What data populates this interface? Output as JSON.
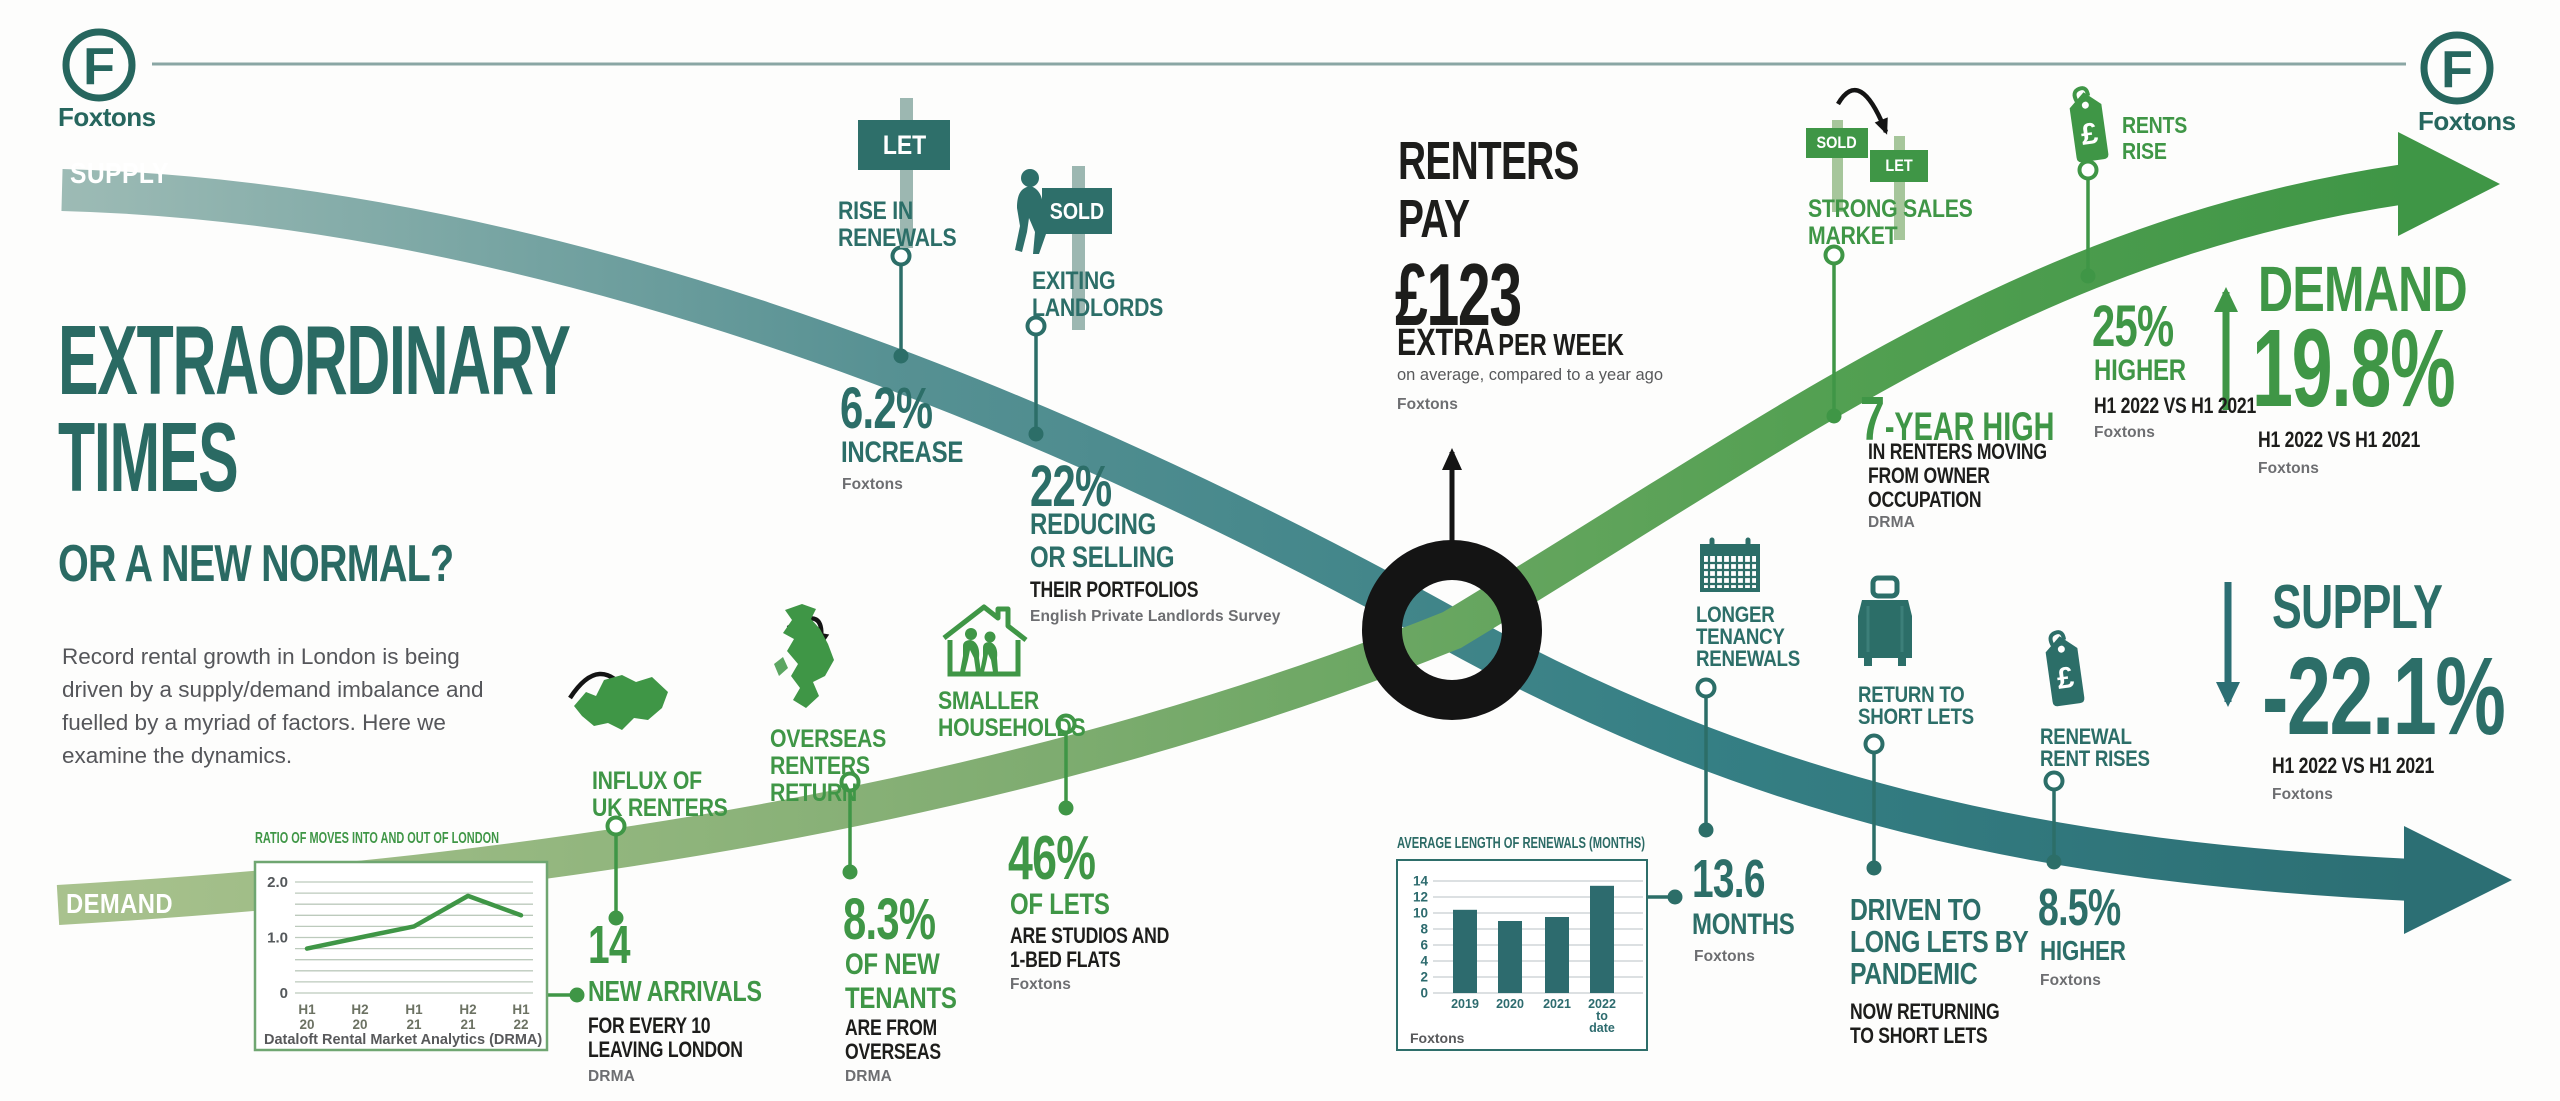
{
  "brand": {
    "logo_letter": "F",
    "wordmark": "Foxtons"
  },
  "curves": {
    "supply_label": "SUPPLY",
    "demand_label": "DEMAND"
  },
  "header": {
    "title": "EXTRAORDINARY\nTIMES",
    "subtitle": "OR A NEW NORMAL?",
    "intro": "Record rental growth in London is being\ndriven by a supply/demand imbalance and\nfuelled by a myriad of factors. Here we\nexamine the dynamics."
  },
  "center_stat": {
    "line1": "RENTERS",
    "line2": "PAY",
    "amount": "£123",
    "extra": "EXTRA",
    "per": "PER WEEK",
    "note": "on average, compared to a year ago",
    "source": "Foxtons"
  },
  "stats": {
    "rise_in_renewals": {
      "sign": "LET",
      "label": "RISE IN\nRENEWALS",
      "value": "6.2%",
      "unit": "INCREASE",
      "source": "Foxtons"
    },
    "exiting_landlords": {
      "sign": "SOLD",
      "label": "EXITING\nLANDLORDS",
      "value": "22%",
      "unit": "REDUCING\nOR SELLING",
      "detail": "THEIR PORTFOLIOS",
      "source": "English Private Landlords Survey"
    },
    "influx_uk": {
      "label": "INFLUX OF\nUK RENTERS",
      "value": "14",
      "unit": "NEW ARRIVALS",
      "detail": "FOR EVERY 10\nLEAVING LONDON",
      "source": "DRMA"
    },
    "overseas": {
      "label": "OVERSEAS\nRENTERS\nRETURN",
      "value": "8.3%",
      "unit": "OF NEW\nTENANTS",
      "detail": "ARE FROM\nOVERSEAS",
      "source": "DRMA"
    },
    "smaller_households": {
      "label": "SMALLER\nHOUSEHOLDS",
      "value": "46%",
      "unit": "OF LETS",
      "detail": "ARE STUDIOS AND\n1-BED FLATS",
      "source": "Foxtons"
    },
    "strong_sales": {
      "sign_from": "SOLD",
      "sign_to": "LET",
      "label": "STRONG SALES\nMARKET",
      "value": "7",
      "suffix": "-YEAR HIGH",
      "detail": "IN RENTERS MOVING\nFROM OWNER\nOCCUPATION",
      "source": "DRMA"
    },
    "rents_rise": {
      "tag": "£",
      "label": "RENTS\nRISE",
      "value": "25%",
      "unit": "HIGHER",
      "detail": "H1 2022 VS H1 2021",
      "source": "Foxtons"
    },
    "demand_change": {
      "label": "DEMAND",
      "value": "19.8%",
      "detail": "H1 2022 VS H1 2021",
      "source": "Foxtons"
    },
    "longer_tenancy": {
      "label": "LONGER\nTENANCY\nRENEWALS",
      "value": "13.6",
      "unit": "MONTHS",
      "source": "Foxtons"
    },
    "return_short_lets": {
      "label": "RETURN TO\nSHORT LETS",
      "value": "DRIVEN TO\nLONG LETS BY\nPANDEMIC",
      "detail": "NOW RETURNING\nTO SHORT LETS"
    },
    "renewal_rent_rises": {
      "tag": "£",
      "label": "RENEWAL\nRENT RISES",
      "value": "8.5%",
      "unit": "HIGHER",
      "source": "Foxtons"
    },
    "supply_change": {
      "label": "SUPPLY",
      "value": "-22.1%",
      "detail": "H1 2022 VS H1 2021",
      "source": "Foxtons"
    }
  },
  "chart_data": [
    {
      "type": "line",
      "title": "RATIO OF MOVES INTO AND OUT OF LONDON",
      "categories": [
        "H1\n20",
        "H2\n20",
        "H1\n21",
        "H2\n21",
        "H1\n22"
      ],
      "values": [
        0.8,
        1.0,
        1.2,
        1.75,
        1.4
      ],
      "ylim": [
        0,
        2.2
      ],
      "yticks": [
        "0",
        "1.0",
        "2.0"
      ],
      "grid_step": 0.2,
      "source": "Dataloft Rental Market Analytics (DRMA)"
    },
    {
      "type": "bar",
      "title": "AVERAGE LENGTH OF RENEWALS (MONTHS)",
      "categories": [
        "2019",
        "2020",
        "2021",
        "2022\nto\ndate"
      ],
      "values": [
        10.4,
        9.0,
        9.5,
        13.4
      ],
      "ylim": [
        0,
        15
      ],
      "yticks": [
        0,
        2,
        4,
        6,
        8,
        10,
        12,
        14
      ],
      "source": "Foxtons",
      "callout": "13.6 MONTHS"
    }
  ]
}
